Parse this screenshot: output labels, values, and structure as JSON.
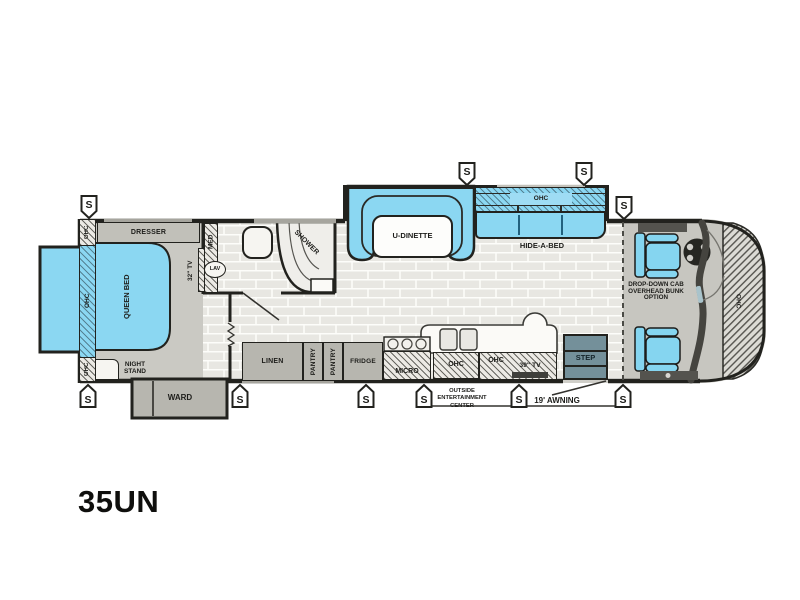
{
  "model": "35UN",
  "marker_s": "S",
  "labels": {
    "dresser": "DRESSER",
    "queen_bed": "QUEEN BED",
    "ohc": "OHC",
    "night_stand": "NIGHT STAND",
    "ward": "WARD",
    "tv32": "32\" TV",
    "med": "MED",
    "lav": "LAV",
    "shower": "SHOWER",
    "linen": "LINEN",
    "pantry": "PANTRY",
    "fridge": "FRIDGE",
    "micro": "MICRO",
    "u_dinette": "U-DINETTE",
    "hide_a_bed": "HIDE-A-BED",
    "tv39": "39\" TV",
    "step": "STEP",
    "outside_line1": "OUTSIDE",
    "outside_line2": "ENTERTAINMENT",
    "outside_line3": "CENTER",
    "awning": "19' AWNING",
    "bunk_line1": "DROP-DOWN CAB",
    "bunk_line2": "OVERHEAD BUNK",
    "bunk_line3": "OPTION"
  },
  "colors": {
    "accent_blue": "#8bd7f2",
    "wall": "#22221e",
    "cabinet": "#b7b6af",
    "step": "#74909a",
    "floor_tile": "#e8e7e2",
    "carpet": "#cac9c3"
  }
}
